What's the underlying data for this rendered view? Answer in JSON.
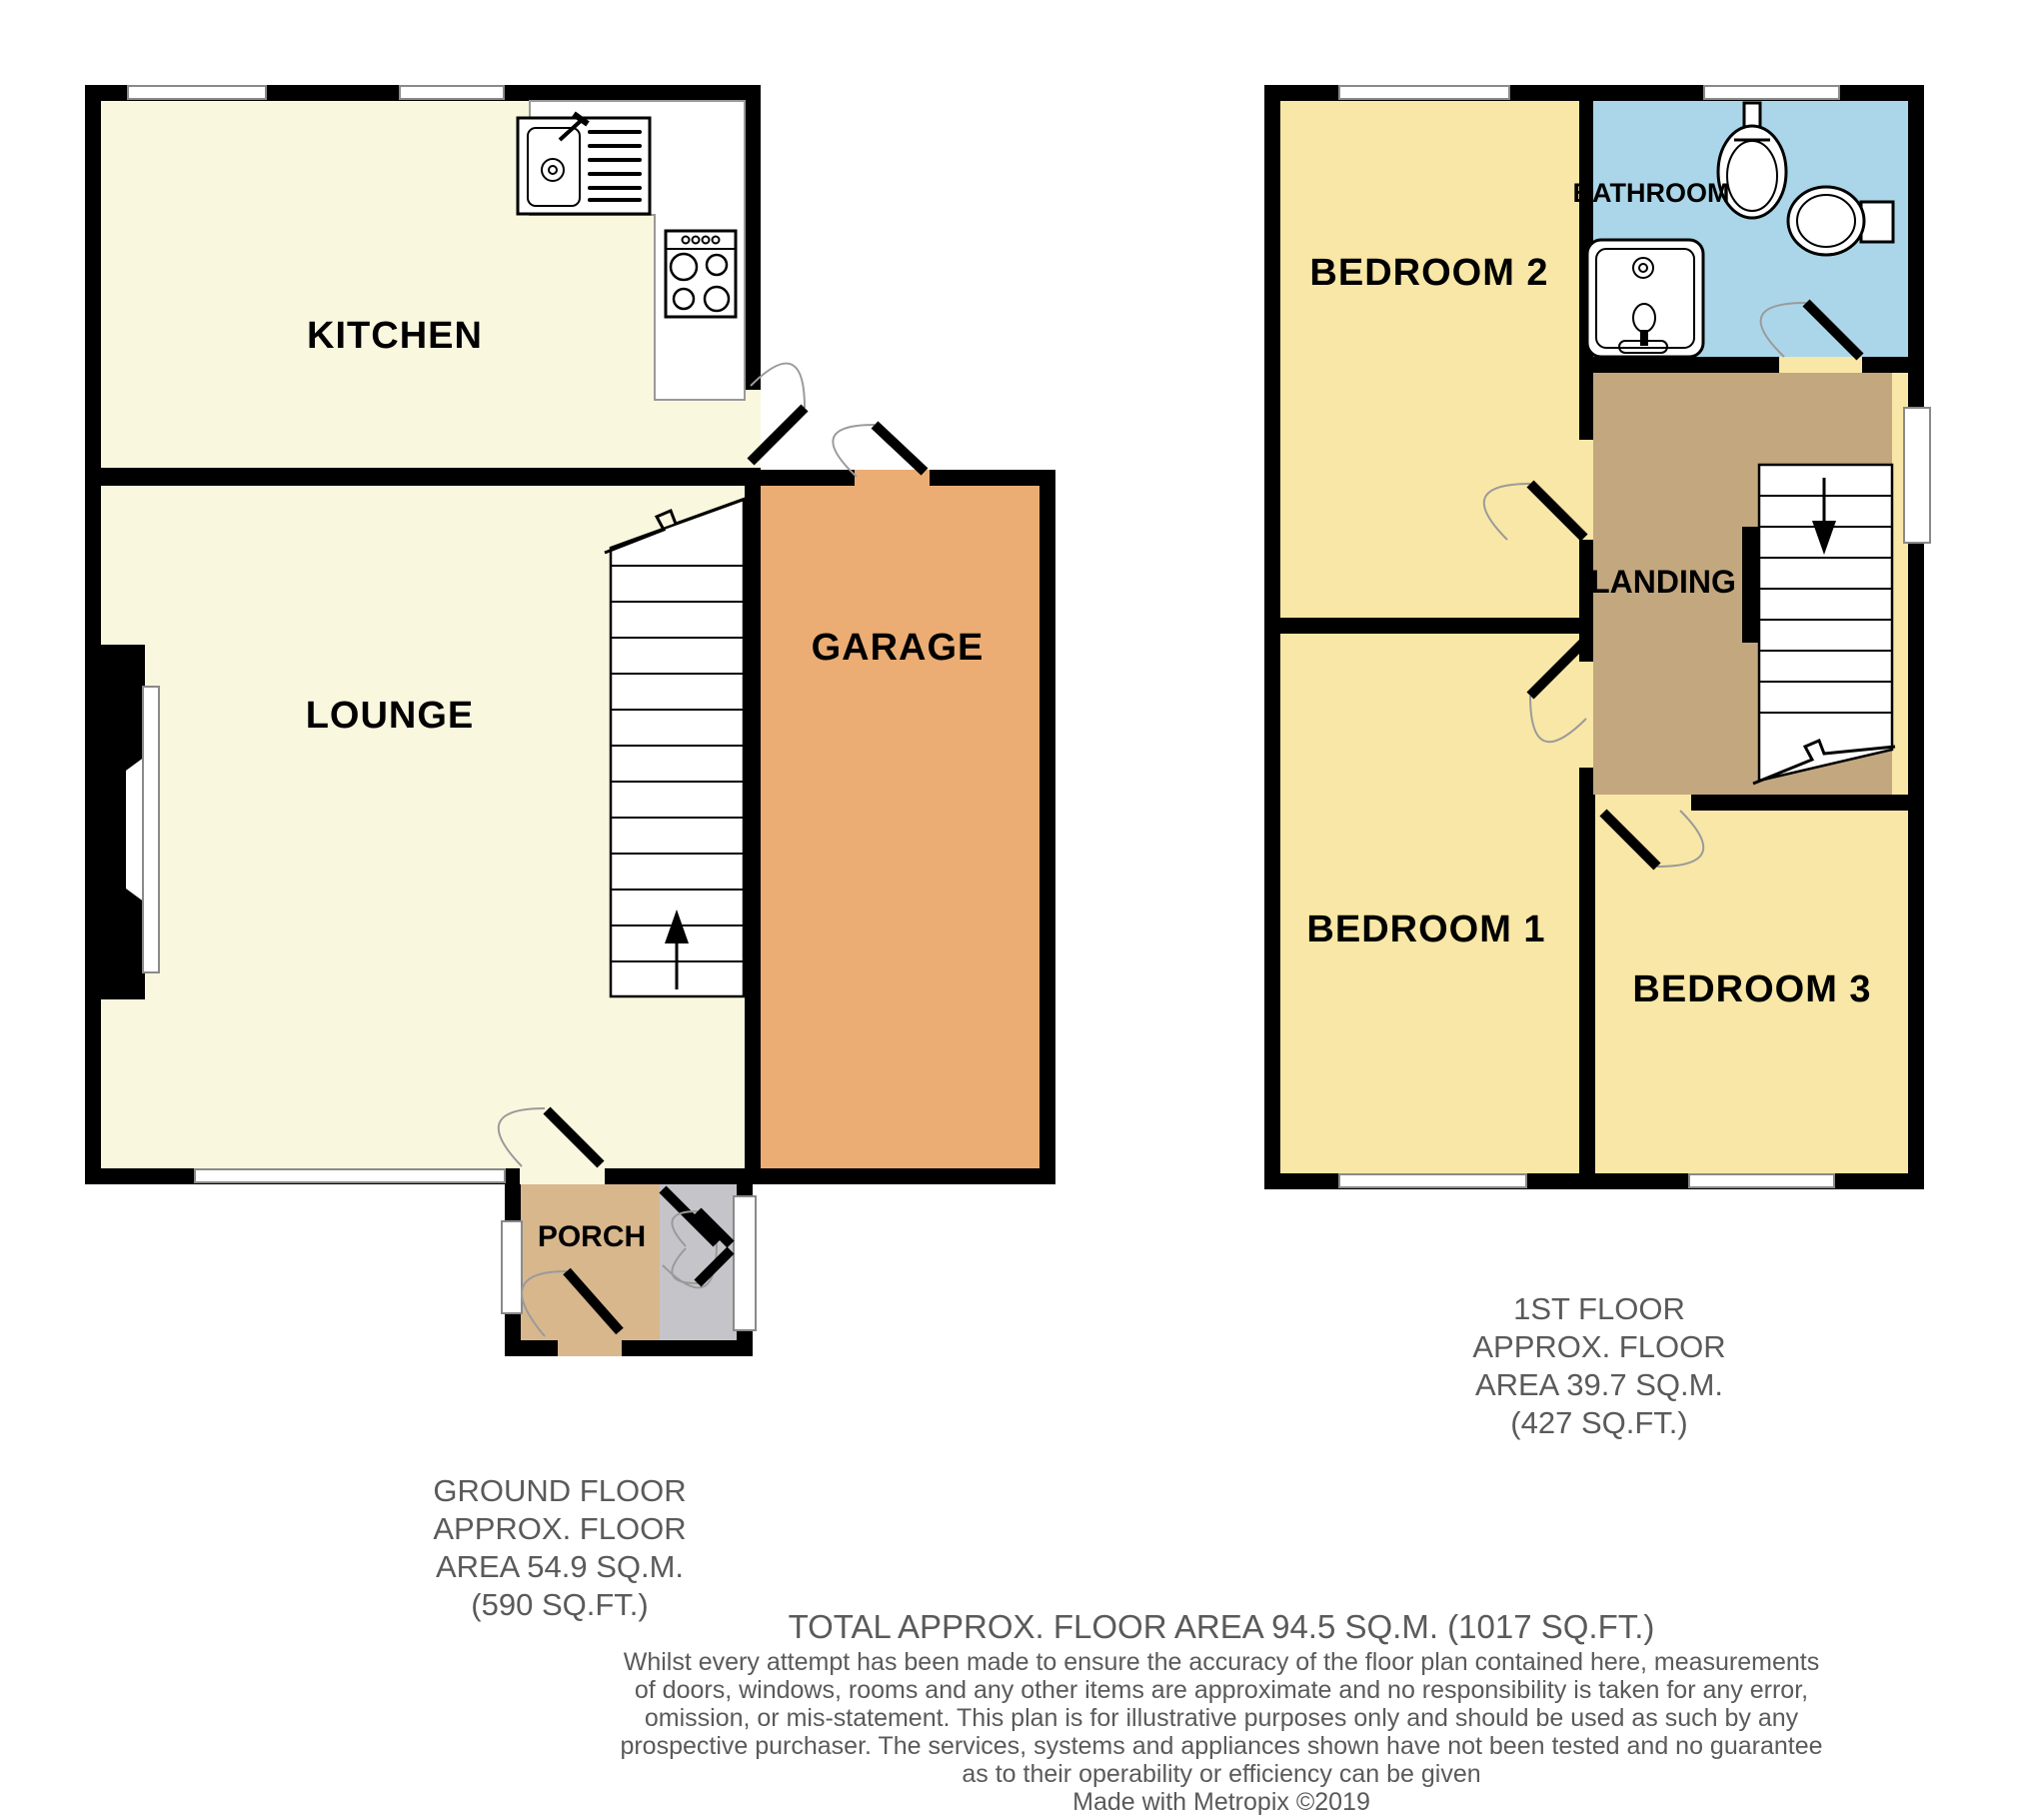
{
  "ground_floor": {
    "rooms": {
      "kitchen": "KITCHEN",
      "lounge": "LOUNGE",
      "garage": "GARAGE",
      "porch": "PORCH"
    },
    "area_lines": [
      "GROUND FLOOR",
      "APPROX. FLOOR",
      "AREA 54.9 SQ.M.",
      "(590 SQ.FT.)"
    ]
  },
  "first_floor": {
    "rooms": {
      "bedroom2": "BEDROOM 2",
      "bathroom": "BATHROOM",
      "landing": "LANDING",
      "bedroom1": "BEDROOM 1",
      "bedroom3": "BEDROOM 3"
    },
    "area_lines": [
      "1ST FLOOR",
      "APPROX. FLOOR",
      "AREA 39.7 SQ.M.",
      "(427 SQ.FT.)"
    ]
  },
  "summary": {
    "total": "TOTAL APPROX. FLOOR AREA 94.5 SQ.M. (1017 SQ.FT.)",
    "disclaimer_lines": [
      "Whilst every attempt has been made to ensure the accuracy of the floor plan contained here, measurements",
      "of doors, windows, rooms and any other items are approximate and no responsibility is taken for any error,",
      "omission, or mis-statement. This plan is for illustrative purposes only and should be used as such by any",
      "prospective purchaser. The services, systems and appliances shown have not been tested and no guarantee",
      "as to their operability or efficiency can be given",
      "Made with Metropix ©2019"
    ]
  },
  "colors": {
    "cream": "#FAF7DF",
    "bedroom_yellow": "#F8E7A6",
    "bathroom_blue": "#ABD6E9",
    "landing_brown": "#C3A77F",
    "garage_orange": "#EBAD74",
    "porch_tan": "#D8B78D",
    "porch_gray": "#C5C4C9",
    "text_gray": "#5A5A5A"
  }
}
